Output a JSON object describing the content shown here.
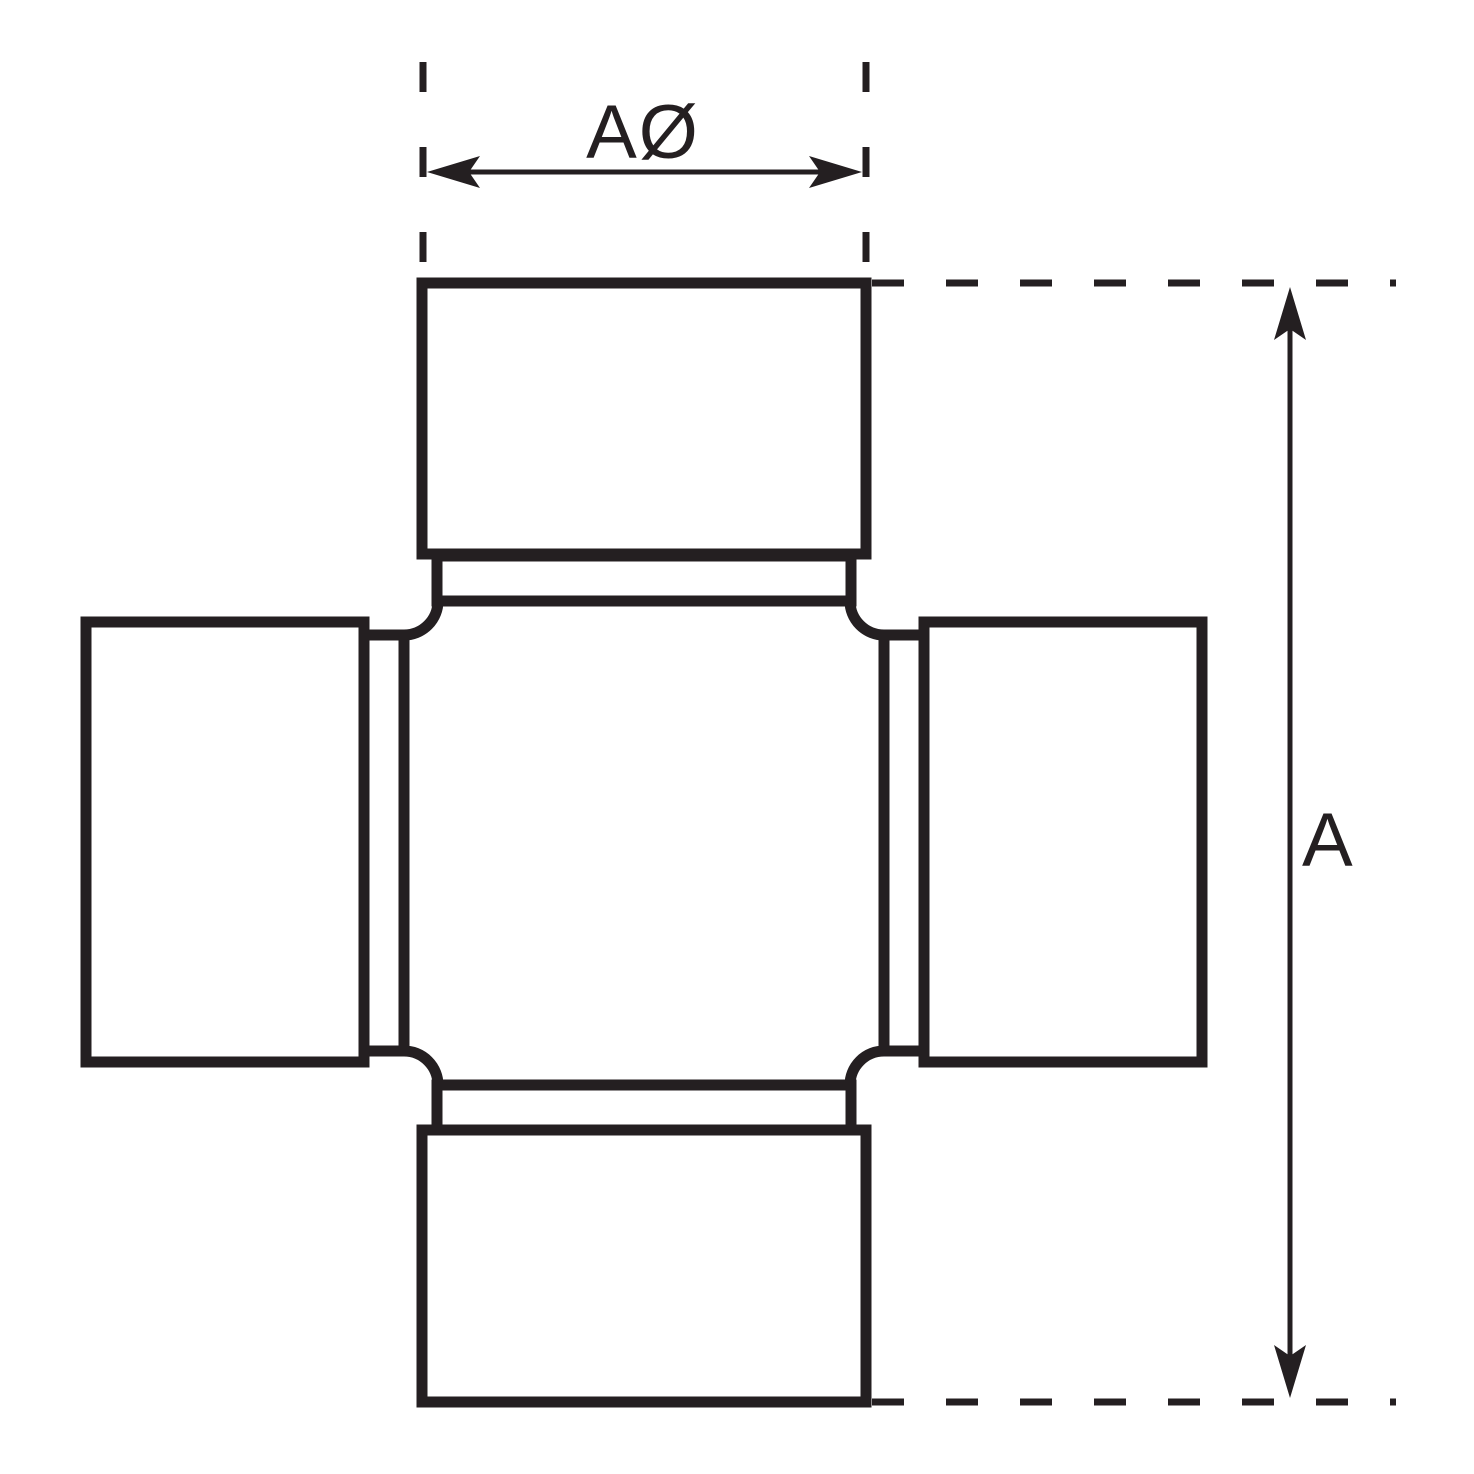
{
  "diagram": {
    "kind": "technical line drawing of a universal joint cross with bearing caps",
    "labels": {
      "width_dimension": "AØ",
      "length_dimension": "A"
    },
    "line_color": "#241f21",
    "background_color": "#ffffff"
  }
}
